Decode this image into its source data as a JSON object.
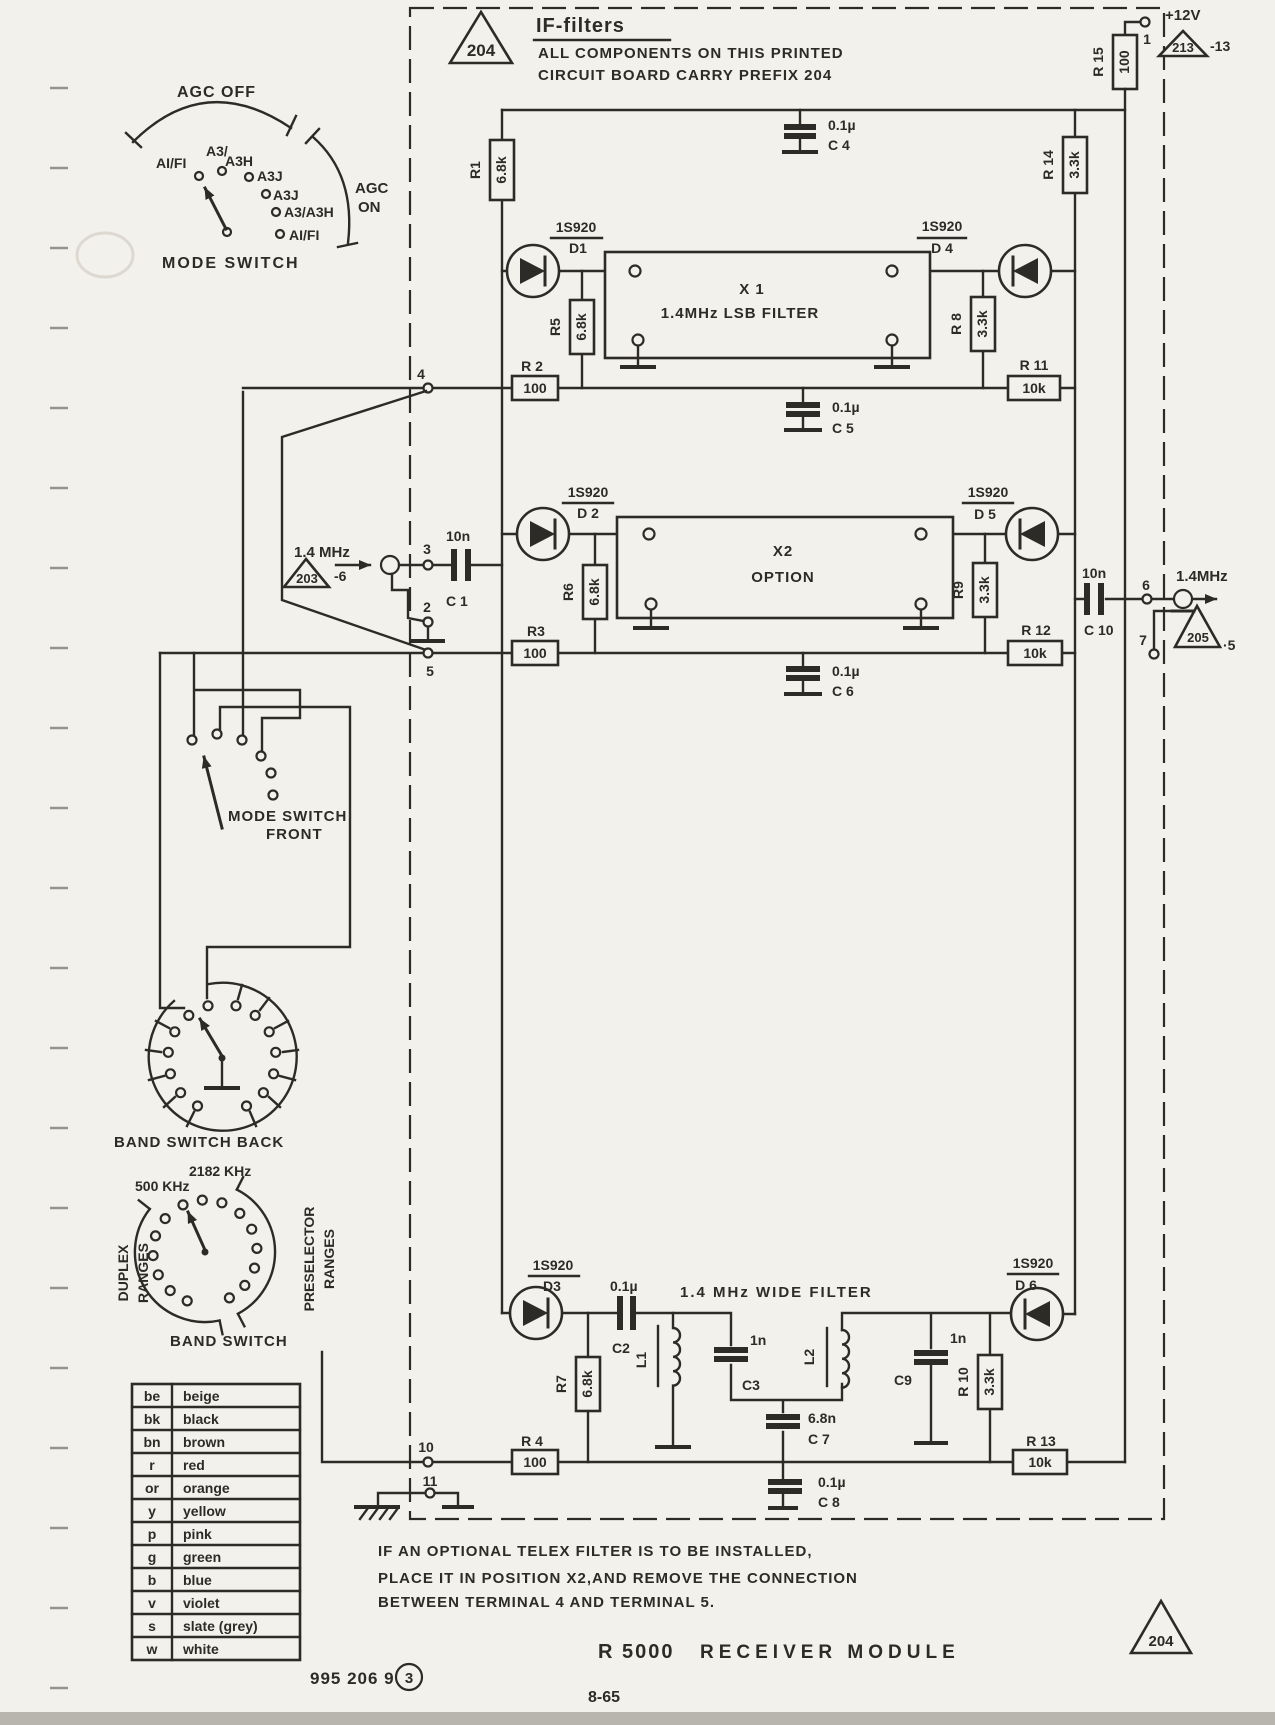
{
  "title_block": {
    "board_ref": "204",
    "title": "IF-filters",
    "note_line1": "ALL COMPONENTS ON THIS PRINTED",
    "note_line2": "CIRCUIT BOARD CARRY PREFIX 204"
  },
  "power": {
    "rail_label": "+12V",
    "terminal_1": "1",
    "ref_board": "213",
    "ref_pin": "-13"
  },
  "signal_in": {
    "freq": "1.4 MHz",
    "ref_board": "203",
    "ref_pin": "-6",
    "terminal_3": "3",
    "terminal_2": "2"
  },
  "signal_out": {
    "freq": "1.4MHz",
    "ref_board": "205",
    "ref_pin": "·5",
    "terminal_6": "6",
    "terminal_7": "7"
  },
  "terminals": {
    "t4": "4",
    "t5": "5",
    "t10": "10",
    "t11": "11"
  },
  "filters": {
    "x1_name": "X 1",
    "x1_desc": "1.4MHz LSB FILTER",
    "x2_name": "X2",
    "x2_desc": "OPTION",
    "wide_label": "1.4 MHz WIDE FILTER",
    "l1": "L1",
    "l2": "L2"
  },
  "diodes": {
    "part": "1S920",
    "d1": "D1",
    "d2": "D 2",
    "d3": "D3",
    "d4": "D 4",
    "d5": "D 5",
    "d6": "D 6"
  },
  "resistors": {
    "r1": {
      "ref": "R1",
      "value": "6.8k"
    },
    "r2": {
      "ref": "R 2",
      "value": "100"
    },
    "r3": {
      "ref": "R3",
      "value": "100"
    },
    "r4": {
      "ref": "R 4",
      "value": "100"
    },
    "r5": {
      "ref": "R5",
      "value": "6.8k"
    },
    "r6": {
      "ref": "R6",
      "value": "6.8k"
    },
    "r7": {
      "ref": "R7",
      "value": "6.8k"
    },
    "r8": {
      "ref": "R 8",
      "value": "3.3k"
    },
    "r9": {
      "ref": "R9",
      "value": "3.3k"
    },
    "r10": {
      "ref": "R 10",
      "value": "3.3k"
    },
    "r11": {
      "ref": "R 11",
      "value": "10k"
    },
    "r12": {
      "ref": "R 12",
      "value": "10k"
    },
    "r13": {
      "ref": "R 13",
      "value": "10k"
    },
    "r14": {
      "ref": "R 14",
      "value": "3.3k"
    },
    "r15": {
      "ref": "R 15",
      "value": "100"
    }
  },
  "capacitors": {
    "c1": {
      "ref": "C 1",
      "value": "10n"
    },
    "c2": {
      "ref": "C2",
      "value": "0.1µ"
    },
    "c3": {
      "ref": "C3",
      "value": "1n"
    },
    "c4": {
      "ref": "C 4",
      "value": "0.1µ"
    },
    "c5": {
      "ref": "C 5",
      "value": "0.1µ"
    },
    "c6": {
      "ref": "C 6",
      "value": "0.1µ"
    },
    "c7": {
      "ref": "C 7",
      "value": "6.8n"
    },
    "c8": {
      "ref": "C 8",
      "value": "0.1µ"
    },
    "c9": {
      "ref": "C9",
      "value": "1n"
    },
    "c10": {
      "ref": "C 10",
      "value": "10n"
    }
  },
  "mode_switch": {
    "agc_off": "AGC OFF",
    "agc_on_line1": "AGC",
    "agc_on_line2": "ON",
    "label": "MODE SWITCH",
    "pos1": "AI/FI",
    "pos2a": "A3/",
    "pos2b": "A3H",
    "pos3": "A3J",
    "pos4": "A3J",
    "pos5": "A3/A3H",
    "pos6": "AI/FI"
  },
  "mode_switch_front": {
    "label_line1": "MODE SWITCH",
    "label_line2": "FRONT"
  },
  "band_switch_back": {
    "label": "BAND SWITCH  BACK"
  },
  "band_switch": {
    "label": "BAND  SWITCH",
    "pos_2182": "2182 KHz",
    "pos_500": "500 KHz",
    "left_line1": "DUPLEX",
    "left_line2": "RANGES",
    "right_line1": "PRESELECTOR",
    "right_line2": "RANGES"
  },
  "color_code": {
    "rows": [
      {
        "abbr": "be",
        "name": "beige"
      },
      {
        "abbr": "bk",
        "name": "black"
      },
      {
        "abbr": "bn",
        "name": "brown"
      },
      {
        "abbr": "r",
        "name": "red"
      },
      {
        "abbr": "or",
        "name": "orange"
      },
      {
        "abbr": "y",
        "name": "yellow"
      },
      {
        "abbr": "p",
        "name": "pink"
      },
      {
        "abbr": "g",
        "name": "green"
      },
      {
        "abbr": "b",
        "name": "blue"
      },
      {
        "abbr": "v",
        "name": "violet"
      },
      {
        "abbr": "s",
        "name": "slate (grey)"
      },
      {
        "abbr": "w",
        "name": "white"
      }
    ]
  },
  "note": {
    "line1": "IF AN OPTIONAL TELEX FILTER IS TO BE INSTALLED,",
    "line2": "PLACE IT IN POSITION X2,AND REMOVE THE CONNECTION",
    "line3": "BETWEEN TERMINAL 4 AND TERMINAL 5."
  },
  "footer": {
    "doc_number": "995 206 9",
    "revision": "3",
    "model": "R 5000",
    "module": "RECEIVER MODULE",
    "page": "8-65",
    "board_ref": "204"
  }
}
